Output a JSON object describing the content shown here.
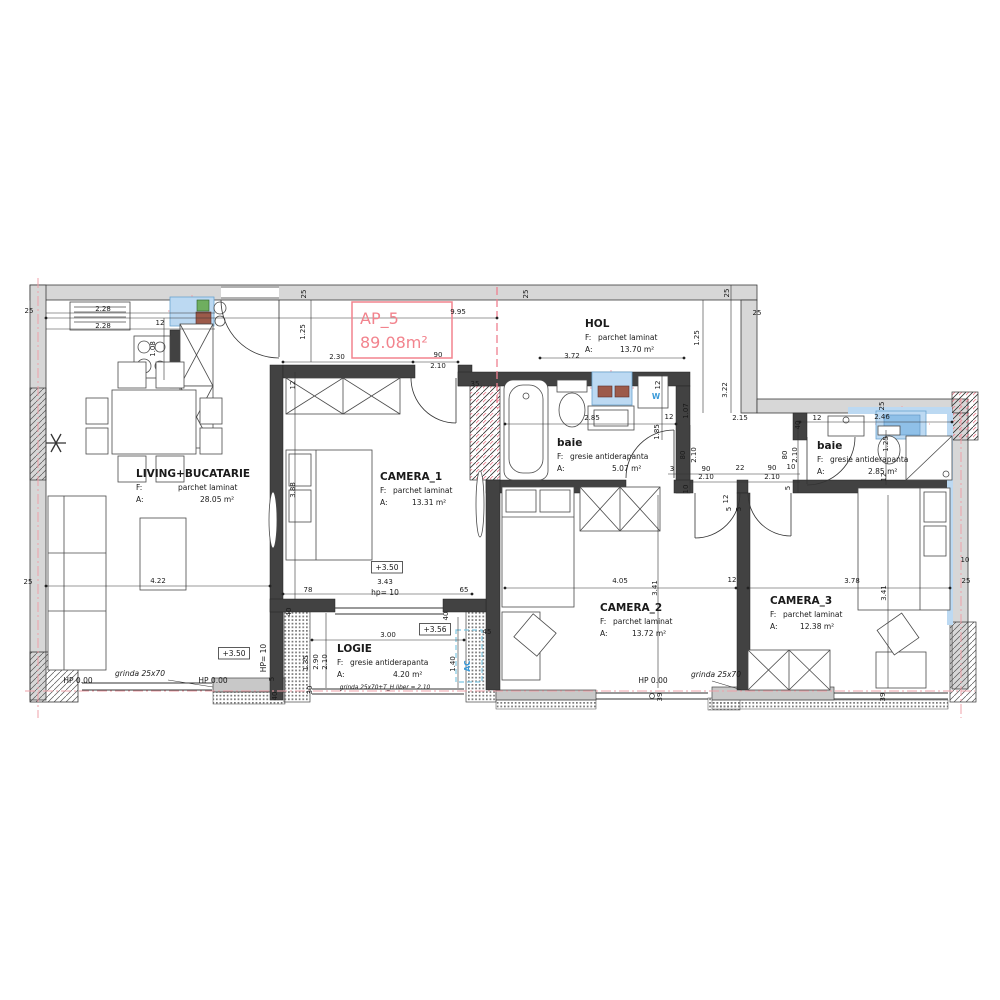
{
  "plan": {
    "ap_label": "AP_5",
    "ap_area": "89.08m²"
  },
  "colors": {
    "accent_pink": "#f2838d",
    "axis_pink": "#efa0a8",
    "fixture_blue": "#bcd9f2",
    "label_blue": "#3a9ad9"
  },
  "rooms": [
    {
      "id": "living",
      "name": "LIVING+BUCATARIE",
      "f_label": "F:",
      "f_value": "parchet laminat",
      "a_label": "A:",
      "a_value": "28.05 m²",
      "x": 136,
      "y": 477,
      "fdx": 42,
      "adx": 64
    },
    {
      "id": "camera1",
      "name": "CAMERA_1",
      "f_label": "F:",
      "f_value": "parchet laminat",
      "a_label": "A:",
      "a_value": "13.31 m²",
      "x": 380,
      "y": 480,
      "fdx": 13,
      "adx": 32
    },
    {
      "id": "hol",
      "name": "HOL",
      "f_label": "F:",
      "f_value": "parchet laminat",
      "a_label": "A:",
      "a_value": "13.70 m²",
      "x": 585,
      "y": 327,
      "fdx": 13,
      "adx": 35
    },
    {
      "id": "baie1",
      "name": "baie",
      "f_label": "F:",
      "f_value": "gresie antiderapanta",
      "a_label": "A:",
      "a_value": "5.07 m²",
      "x": 557,
      "y": 446,
      "fdx": 13,
      "adx": 55
    },
    {
      "id": "baie2",
      "name": "baie",
      "f_label": "F:",
      "f_value": "gresie antiderapanta",
      "a_label": "A:",
      "a_value": "2.85 m²",
      "x": 817,
      "y": 449,
      "fdx": 13,
      "adx": 51
    },
    {
      "id": "camera2",
      "name": "CAMERA_2",
      "f_label": "F:",
      "f_value": "parchet laminat",
      "a_label": "A:",
      "a_value": "13.72 m²",
      "x": 600,
      "y": 611,
      "fdx": 13,
      "adx": 32
    },
    {
      "id": "camera3",
      "name": "CAMERA_3",
      "f_label": "F:",
      "f_value": "parchet laminat",
      "a_label": "A:",
      "a_value": "12.38 m²",
      "x": 770,
      "y": 604,
      "fdx": 13,
      "adx": 30
    },
    {
      "id": "logie",
      "name": "LOGIE",
      "f_label": "F:",
      "f_value": "gresie antiderapanta",
      "a_label": "A:",
      "a_value": "4.20 m²",
      "x": 337,
      "y": 652,
      "fdx": 13,
      "adx": 56
    }
  ],
  "dimensions": [
    {
      "v": "25",
      "x": 306,
      "y": 294,
      "r": -90
    },
    {
      "v": "25",
      "x": 528,
      "y": 294,
      "r": -90
    },
    {
      "v": "25",
      "x": 729,
      "y": 293,
      "r": -90
    },
    {
      "v": "25",
      "x": 757,
      "y": 315
    },
    {
      "v": "25",
      "x": 29,
      "y": 313
    },
    {
      "v": "9.95",
      "x": 458,
      "y": 314
    },
    {
      "v": "1.25",
      "x": 305,
      "y": 332,
      "r": -90
    },
    {
      "v": "1.25",
      "x": 699,
      "y": 338,
      "r": -90
    },
    {
      "v": "2.30",
      "x": 337,
      "y": 359
    },
    {
      "v": "90",
      "x": 438,
      "y": 357
    },
    {
      "v": "2.10",
      "x": 438,
      "y": 368
    },
    {
      "v": "35",
      "x": 475,
      "y": 386
    },
    {
      "v": "3.72",
      "x": 572,
      "y": 358
    },
    {
      "v": "3.22",
      "x": 727,
      "y": 390,
      "r": -90
    },
    {
      "v": "1.07",
      "x": 688,
      "y": 411,
      "r": -90
    },
    {
      "v": "2.28",
      "x": 103,
      "y": 311
    },
    {
      "v": "2.28",
      "x": 103,
      "y": 328
    },
    {
      "v": "12",
      "x": 160,
      "y": 325
    },
    {
      "v": "1.08",
      "x": 155,
      "y": 349,
      "r": -90
    },
    {
      "v": "12",
      "x": 295,
      "y": 385,
      "r": -90
    },
    {
      "v": "3.88",
      "x": 295,
      "y": 490,
      "r": -90
    },
    {
      "v": "78",
      "x": 308,
      "y": 592
    },
    {
      "v": "3.43",
      "x": 385,
      "y": 584
    },
    {
      "v": "65",
      "x": 464,
      "y": 592
    },
    {
      "v": "4.22",
      "x": 158,
      "y": 583
    },
    {
      "v": "25",
      "x": 28,
      "y": 584
    },
    {
      "v": "2.85",
      "x": 592,
      "y": 420
    },
    {
      "v": "12",
      "x": 669,
      "y": 419
    },
    {
      "v": "1.85",
      "x": 659,
      "y": 432,
      "r": -90
    },
    {
      "v": "12",
      "x": 660,
      "y": 385,
      "r": -90
    },
    {
      "v": "2.15",
      "x": 740,
      "y": 420
    },
    {
      "v": "80",
      "x": 685,
      "y": 455,
      "r": -90
    },
    {
      "v": "2.10",
      "x": 696,
      "y": 455,
      "r": -90
    },
    {
      "v": "80",
      "x": 787,
      "y": 455,
      "r": -90
    },
    {
      "v": "2.10",
      "x": 797,
      "y": 455,
      "r": -90
    },
    {
      "v": "3",
      "x": 672,
      "y": 471
    },
    {
      "v": "90",
      "x": 706,
      "y": 471
    },
    {
      "v": "22",
      "x": 740,
      "y": 470
    },
    {
      "v": "90",
      "x": 772,
      "y": 470
    },
    {
      "v": "10",
      "x": 791,
      "y": 469
    },
    {
      "v": "2.10",
      "x": 706,
      "y": 479
    },
    {
      "v": "2.10",
      "x": 772,
      "y": 479
    },
    {
      "v": "10",
      "x": 688,
      "y": 489,
      "r": -90
    },
    {
      "v": "5",
      "x": 790,
      "y": 488,
      "r": -90
    },
    {
      "v": "12",
      "x": 728,
      "y": 499,
      "r": -90
    },
    {
      "v": "5",
      "x": 731,
      "y": 509,
      "r": -90
    },
    {
      "v": "5",
      "x": 741,
      "y": 509,
      "r": -90
    },
    {
      "v": "12",
      "x": 817,
      "y": 420
    },
    {
      "v": "2.46",
      "x": 882,
      "y": 419
    },
    {
      "v": "40",
      "x": 800,
      "y": 425,
      "r": -90
    },
    {
      "v": "1.25",
      "x": 888,
      "y": 444,
      "r": -90
    },
    {
      "v": "12",
      "x": 886,
      "y": 477,
      "r": -90
    },
    {
      "v": "25",
      "x": 884,
      "y": 406,
      "r": -90
    },
    {
      "v": "4.05",
      "x": 620,
      "y": 583
    },
    {
      "v": "3.41",
      "x": 657,
      "y": 588,
      "r": -90
    },
    {
      "v": "12",
      "x": 732,
      "y": 582
    },
    {
      "v": "39",
      "x": 662,
      "y": 697,
      "r": -90
    },
    {
      "v": "3.78",
      "x": 852,
      "y": 583
    },
    {
      "v": "3.41",
      "x": 886,
      "y": 593,
      "r": -90
    },
    {
      "v": "25",
      "x": 966,
      "y": 583
    },
    {
      "v": "10",
      "x": 965,
      "y": 562
    },
    {
      "v": "39",
      "x": 885,
      "y": 697,
      "r": -90
    },
    {
      "v": "3.00",
      "x": 388,
      "y": 637
    },
    {
      "v": "1.35",
      "x": 308,
      "y": 663,
      "r": -90
    },
    {
      "v": "2.90",
      "x": 318,
      "y": 662,
      "r": -90
    },
    {
      "v": "2.10",
      "x": 327,
      "y": 662,
      "r": -90
    },
    {
      "v": "1.40",
      "x": 455,
      "y": 664,
      "r": -90
    },
    {
      "v": "45",
      "x": 487,
      "y": 634
    },
    {
      "v": "40",
      "x": 291,
      "y": 612,
      "r": -90
    },
    {
      "v": "40",
      "x": 448,
      "y": 616,
      "r": -90
    },
    {
      "v": "30",
      "x": 312,
      "y": 690,
      "r": -90
    },
    {
      "v": "5",
      "x": 274,
      "y": 679,
      "r": -90
    },
    {
      "v": "40",
      "x": 277,
      "y": 696,
      "r": -90
    }
  ],
  "annotations": [
    {
      "v": "HP 0.00",
      "x": 78,
      "y": 683
    },
    {
      "v": "HP 0.00",
      "x": 213,
      "y": 683
    },
    {
      "v": "HP 0.00",
      "x": 653,
      "y": 683
    },
    {
      "v": "grinda 25x70",
      "x": 140,
      "y": 676,
      "italic": true
    },
    {
      "v": "grinda 25x70",
      "x": 716,
      "y": 677,
      "italic": true
    },
    {
      "v": "grinda 25x70+T_H liber = 2.10",
      "x": 385,
      "y": 689,
      "italic": true,
      "small": true
    },
    {
      "v": "+3.50",
      "x": 234,
      "y": 656,
      "box": true
    },
    {
      "v": "+3.50",
      "x": 387,
      "y": 570,
      "box": true
    },
    {
      "v": "+3.56",
      "x": 435,
      "y": 632,
      "box": true
    },
    {
      "v": "hp= 10",
      "x": 385,
      "y": 595
    },
    {
      "v": "HP= 10",
      "x": 266,
      "y": 658,
      "r": -90
    },
    {
      "v": "W",
      "x": 656,
      "y": 399,
      "blue": true,
      "size": 11
    },
    {
      "v": "AC",
      "x": 470,
      "y": 666,
      "blue": true,
      "r": -90
    }
  ]
}
